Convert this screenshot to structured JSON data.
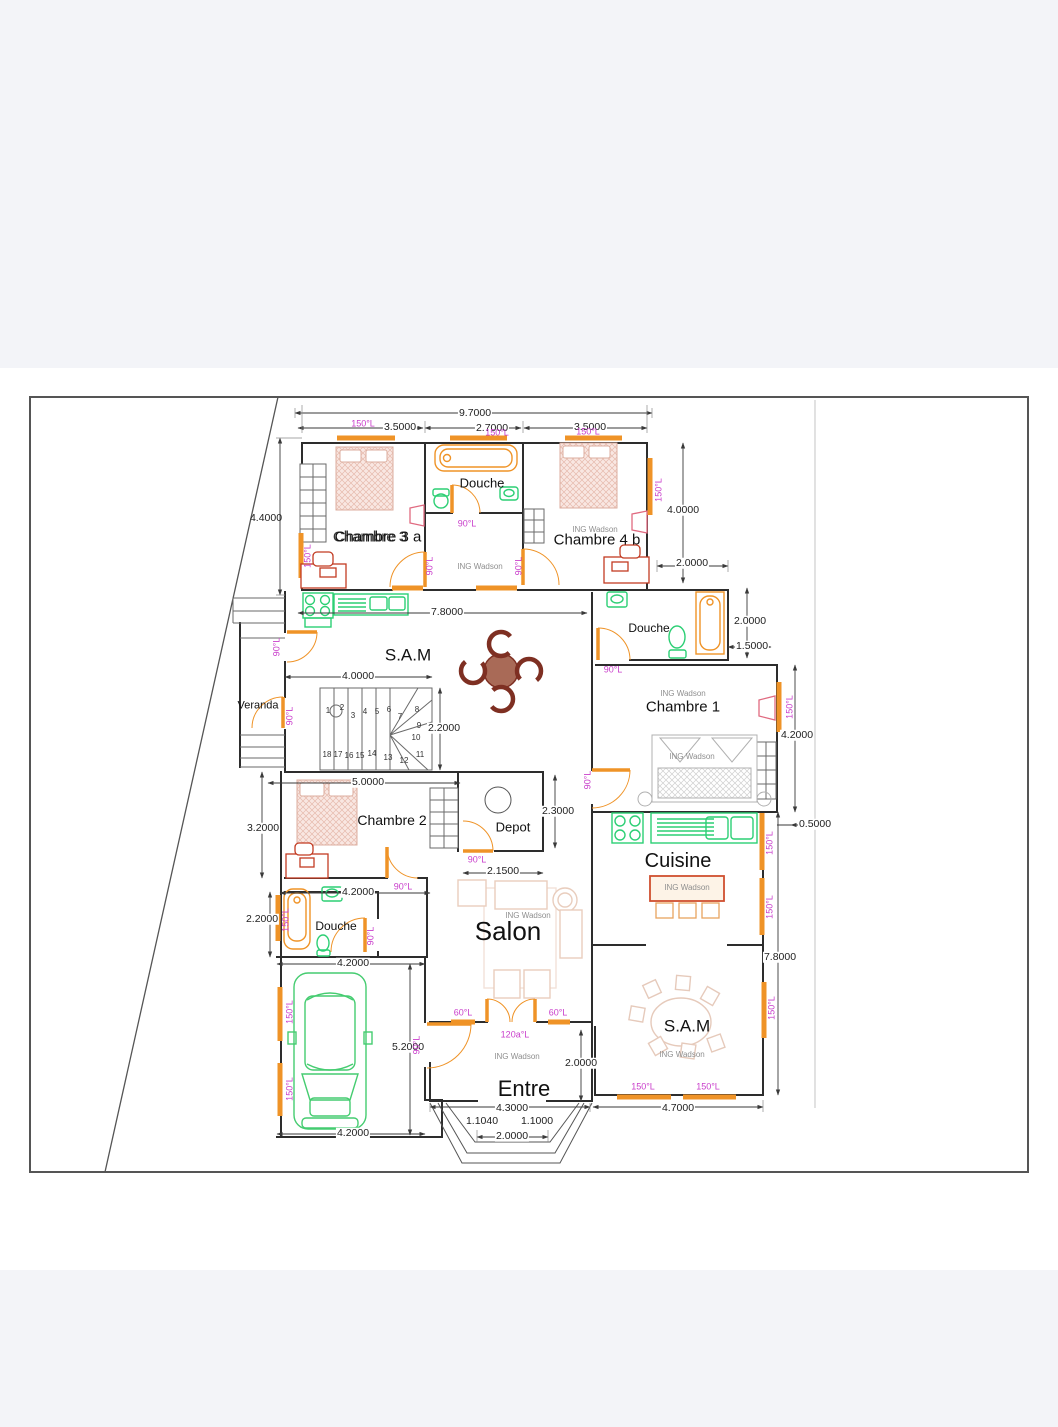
{
  "palette": {
    "margin": "#f3f4f8",
    "sheet": "#ffffff",
    "wall": "#2d2d2d",
    "thin": "#6a6a6a",
    "border": "#555555",
    "dimline": "#3a3a3a",
    "orange": "#ef9327",
    "green": "#2ccf74",
    "magenta": "#c93ecb",
    "maroon": "#7e2f22",
    "table_brown": "#a96a57",
    "desk_red": "#c23b22",
    "bed_stroke": "#dcae9f",
    "bed_fill": "#f9e7e2",
    "faded": "#e9cdbd",
    "gray": "#999999"
  },
  "plan": {
    "watermark_text": "ING Wadson",
    "rooms": [
      {
        "text": "Douche",
        "x": 482,
        "y": 483,
        "s": 13
      },
      {
        "text": "Chambre 3 a",
        "x": 378,
        "y": 537,
        "s": 15
      },
      {
        "text": "Chambre 4 b",
        "x": 597,
        "y": 540,
        "s": 15
      },
      {
        "text": "S.A.M",
        "x": 408,
        "y": 655,
        "s": 17
      },
      {
        "text": "Douche",
        "x": 649,
        "y": 628,
        "s": 12
      },
      {
        "text": "Chambre 1",
        "x": 683,
        "y": 707,
        "s": 15
      },
      {
        "text": "Veranda",
        "x": 258,
        "y": 706,
        "s": 11
      },
      {
        "text": "Chambre 2",
        "x": 392,
        "y": 820,
        "s": 14
      },
      {
        "text": "Depot",
        "x": 513,
        "y": 827,
        "s": 13
      },
      {
        "text": "Cuisine",
        "x": 678,
        "y": 861,
        "s": 20
      },
      {
        "text": "Salon",
        "x": 508,
        "y": 931,
        "s": 26
      },
      {
        "text": "Douche",
        "x": 336,
        "y": 926,
        "s": 12
      },
      {
        "text": "S.A.M",
        "x": 687,
        "y": 1026,
        "s": 17
      },
      {
        "text": "Entre",
        "x": 524,
        "y": 1089,
        "s": 22
      }
    ],
    "ghost_labels": [
      {
        "text": "Chambre 3",
        "x": 370,
        "y": 537,
        "s": 15
      }
    ],
    "dimensions": [
      {
        "text": "9.7000",
        "x": 475,
        "y": 413,
        "bg": 1
      },
      {
        "text": "3.5000",
        "x": 400,
        "y": 427,
        "bg": 1
      },
      {
        "text": "2.7000",
        "x": 492,
        "y": 428,
        "bg": 1
      },
      {
        "text": "3.5000",
        "x": 590,
        "y": 427,
        "bg": 1
      },
      {
        "text": "4.4000",
        "x": 266,
        "y": 518
      },
      {
        "text": "4.0000",
        "x": 683,
        "y": 510,
        "bg": 1
      },
      {
        "text": "2.0000",
        "x": 692,
        "y": 563,
        "bg": 1
      },
      {
        "text": "2.0000",
        "x": 750,
        "y": 621,
        "bg": 1
      },
      {
        "text": "1.5000",
        "x": 752,
        "y": 646,
        "bg": 1
      },
      {
        "text": "4.2000",
        "x": 797,
        "y": 735,
        "bg": 1
      },
      {
        "text": "0.5000",
        "x": 815,
        "y": 824,
        "bg": 1
      },
      {
        "text": "7.8000",
        "x": 780,
        "y": 957,
        "bg": 1
      },
      {
        "text": "7.8000",
        "x": 447,
        "y": 612,
        "bg": 1
      },
      {
        "text": "4.0000",
        "x": 358,
        "y": 676,
        "bg": 1
      },
      {
        "text": "2.2000",
        "x": 444,
        "y": 728,
        "bg": 1
      },
      {
        "text": "5.0000",
        "x": 368,
        "y": 782,
        "bg": 1
      },
      {
        "text": "3.2000",
        "x": 263,
        "y": 828,
        "bg": 1
      },
      {
        "text": "2.3000",
        "x": 558,
        "y": 811,
        "bg": 1
      },
      {
        "text": "2.1500",
        "x": 503,
        "y": 871,
        "bg": 1
      },
      {
        "text": "4.2000",
        "x": 358,
        "y": 892,
        "bg": 1
      },
      {
        "text": "2.2000",
        "x": 262,
        "y": 919,
        "bg": 1
      },
      {
        "text": "4.2000",
        "x": 353,
        "y": 963,
        "bg": 1
      },
      {
        "text": "5.2000",
        "x": 408,
        "y": 1047,
        "bg": 1
      },
      {
        "text": "4.2000",
        "x": 353,
        "y": 1133,
        "bg": 1
      },
      {
        "text": "2.0000",
        "x": 581,
        "y": 1063,
        "bg": 1
      },
      {
        "text": "4.3000",
        "x": 512,
        "y": 1108,
        "bg": 1
      },
      {
        "text": "1.1040",
        "x": 482,
        "y": 1121
      },
      {
        "text": "1.1000",
        "x": 537,
        "y": 1121
      },
      {
        "text": "2.0000",
        "x": 512,
        "y": 1136,
        "bg": 1
      },
      {
        "text": "4.7000",
        "x": 678,
        "y": 1108,
        "bg": 1
      }
    ],
    "angle_labels": [
      {
        "text": "150°L",
        "x": 363,
        "y": 424
      },
      {
        "text": "150°L",
        "x": 497,
        "y": 433
      },
      {
        "text": "150°L",
        "x": 588,
        "y": 432
      },
      {
        "text": "150°L",
        "x": 308,
        "y": 556,
        "rot": 1
      },
      {
        "text": "150°L",
        "x": 659,
        "y": 490,
        "rot": 1
      },
      {
        "text": "90°L",
        "x": 467,
        "y": 524
      },
      {
        "text": "90°L",
        "x": 430,
        "y": 566,
        "rot": 1
      },
      {
        "text": "90°L",
        "x": 519,
        "y": 566,
        "rot": 1
      },
      {
        "text": "90°L",
        "x": 277,
        "y": 647,
        "rot": 1
      },
      {
        "text": "90°L",
        "x": 290,
        "y": 716,
        "rot": 1
      },
      {
        "text": "90°L",
        "x": 613,
        "y": 670
      },
      {
        "text": "150°L",
        "x": 790,
        "y": 707,
        "rot": 1
      },
      {
        "text": "90°L",
        "x": 588,
        "y": 780,
        "rot": 1
      },
      {
        "text": "90°L",
        "x": 403,
        "y": 887
      },
      {
        "text": "90°L",
        "x": 477,
        "y": 860
      },
      {
        "text": "150°L",
        "x": 286,
        "y": 920,
        "rot": 1
      },
      {
        "text": "90°L",
        "x": 371,
        "y": 936,
        "rot": 1
      },
      {
        "text": "150°L",
        "x": 770,
        "y": 843,
        "rot": 1
      },
      {
        "text": "150°L",
        "x": 770,
        "y": 907,
        "rot": 1
      },
      {
        "text": "150°L",
        "x": 772,
        "y": 1008,
        "rot": 1
      },
      {
        "text": "150°L",
        "x": 643,
        "y": 1087
      },
      {
        "text": "150°L",
        "x": 708,
        "y": 1087
      },
      {
        "text": "60°L",
        "x": 463,
        "y": 1013
      },
      {
        "text": "60°L",
        "x": 558,
        "y": 1013
      },
      {
        "text": "120a°L",
        "x": 515,
        "y": 1035
      },
      {
        "text": "150°L",
        "x": 290,
        "y": 1012,
        "rot": 1
      },
      {
        "text": "150°L",
        "x": 290,
        "y": 1089,
        "rot": 1
      },
      {
        "text": "90°L",
        "x": 417,
        "y": 1045,
        "rot": 1
      }
    ],
    "watermarks": [
      {
        "x": 595,
        "y": 530
      },
      {
        "x": 480,
        "y": 567
      },
      {
        "x": 683,
        "y": 694
      },
      {
        "x": 692,
        "y": 757
      },
      {
        "x": 528,
        "y": 916
      },
      {
        "x": 687,
        "y": 888
      },
      {
        "x": 517,
        "y": 1057
      },
      {
        "x": 682,
        "y": 1055
      }
    ],
    "stair_numbers": [
      {
        "n": "1",
        "x": 328,
        "y": 711
      },
      {
        "n": "2",
        "x": 342,
        "y": 708
      },
      {
        "n": "3",
        "x": 353,
        "y": 716
      },
      {
        "n": "4",
        "x": 365,
        "y": 712
      },
      {
        "n": "5",
        "x": 377,
        "y": 712
      },
      {
        "n": "6",
        "x": 389,
        "y": 710
      },
      {
        "n": "7",
        "x": 400,
        "y": 717
      },
      {
        "n": "8",
        "x": 417,
        "y": 710
      },
      {
        "n": "9",
        "x": 419,
        "y": 726
      },
      {
        "n": "10",
        "x": 416,
        "y": 738
      },
      {
        "n": "11",
        "x": 420,
        "y": 755
      },
      {
        "n": "12",
        "x": 404,
        "y": 761
      },
      {
        "n": "13",
        "x": 388,
        "y": 758
      },
      {
        "n": "14",
        "x": 372,
        "y": 754
      },
      {
        "n": "15",
        "x": 360,
        "y": 756
      },
      {
        "n": "16",
        "x": 349,
        "y": 756
      },
      {
        "n": "17",
        "x": 338,
        "y": 755
      },
      {
        "n": "18",
        "x": 327,
        "y": 755
      }
    ]
  }
}
